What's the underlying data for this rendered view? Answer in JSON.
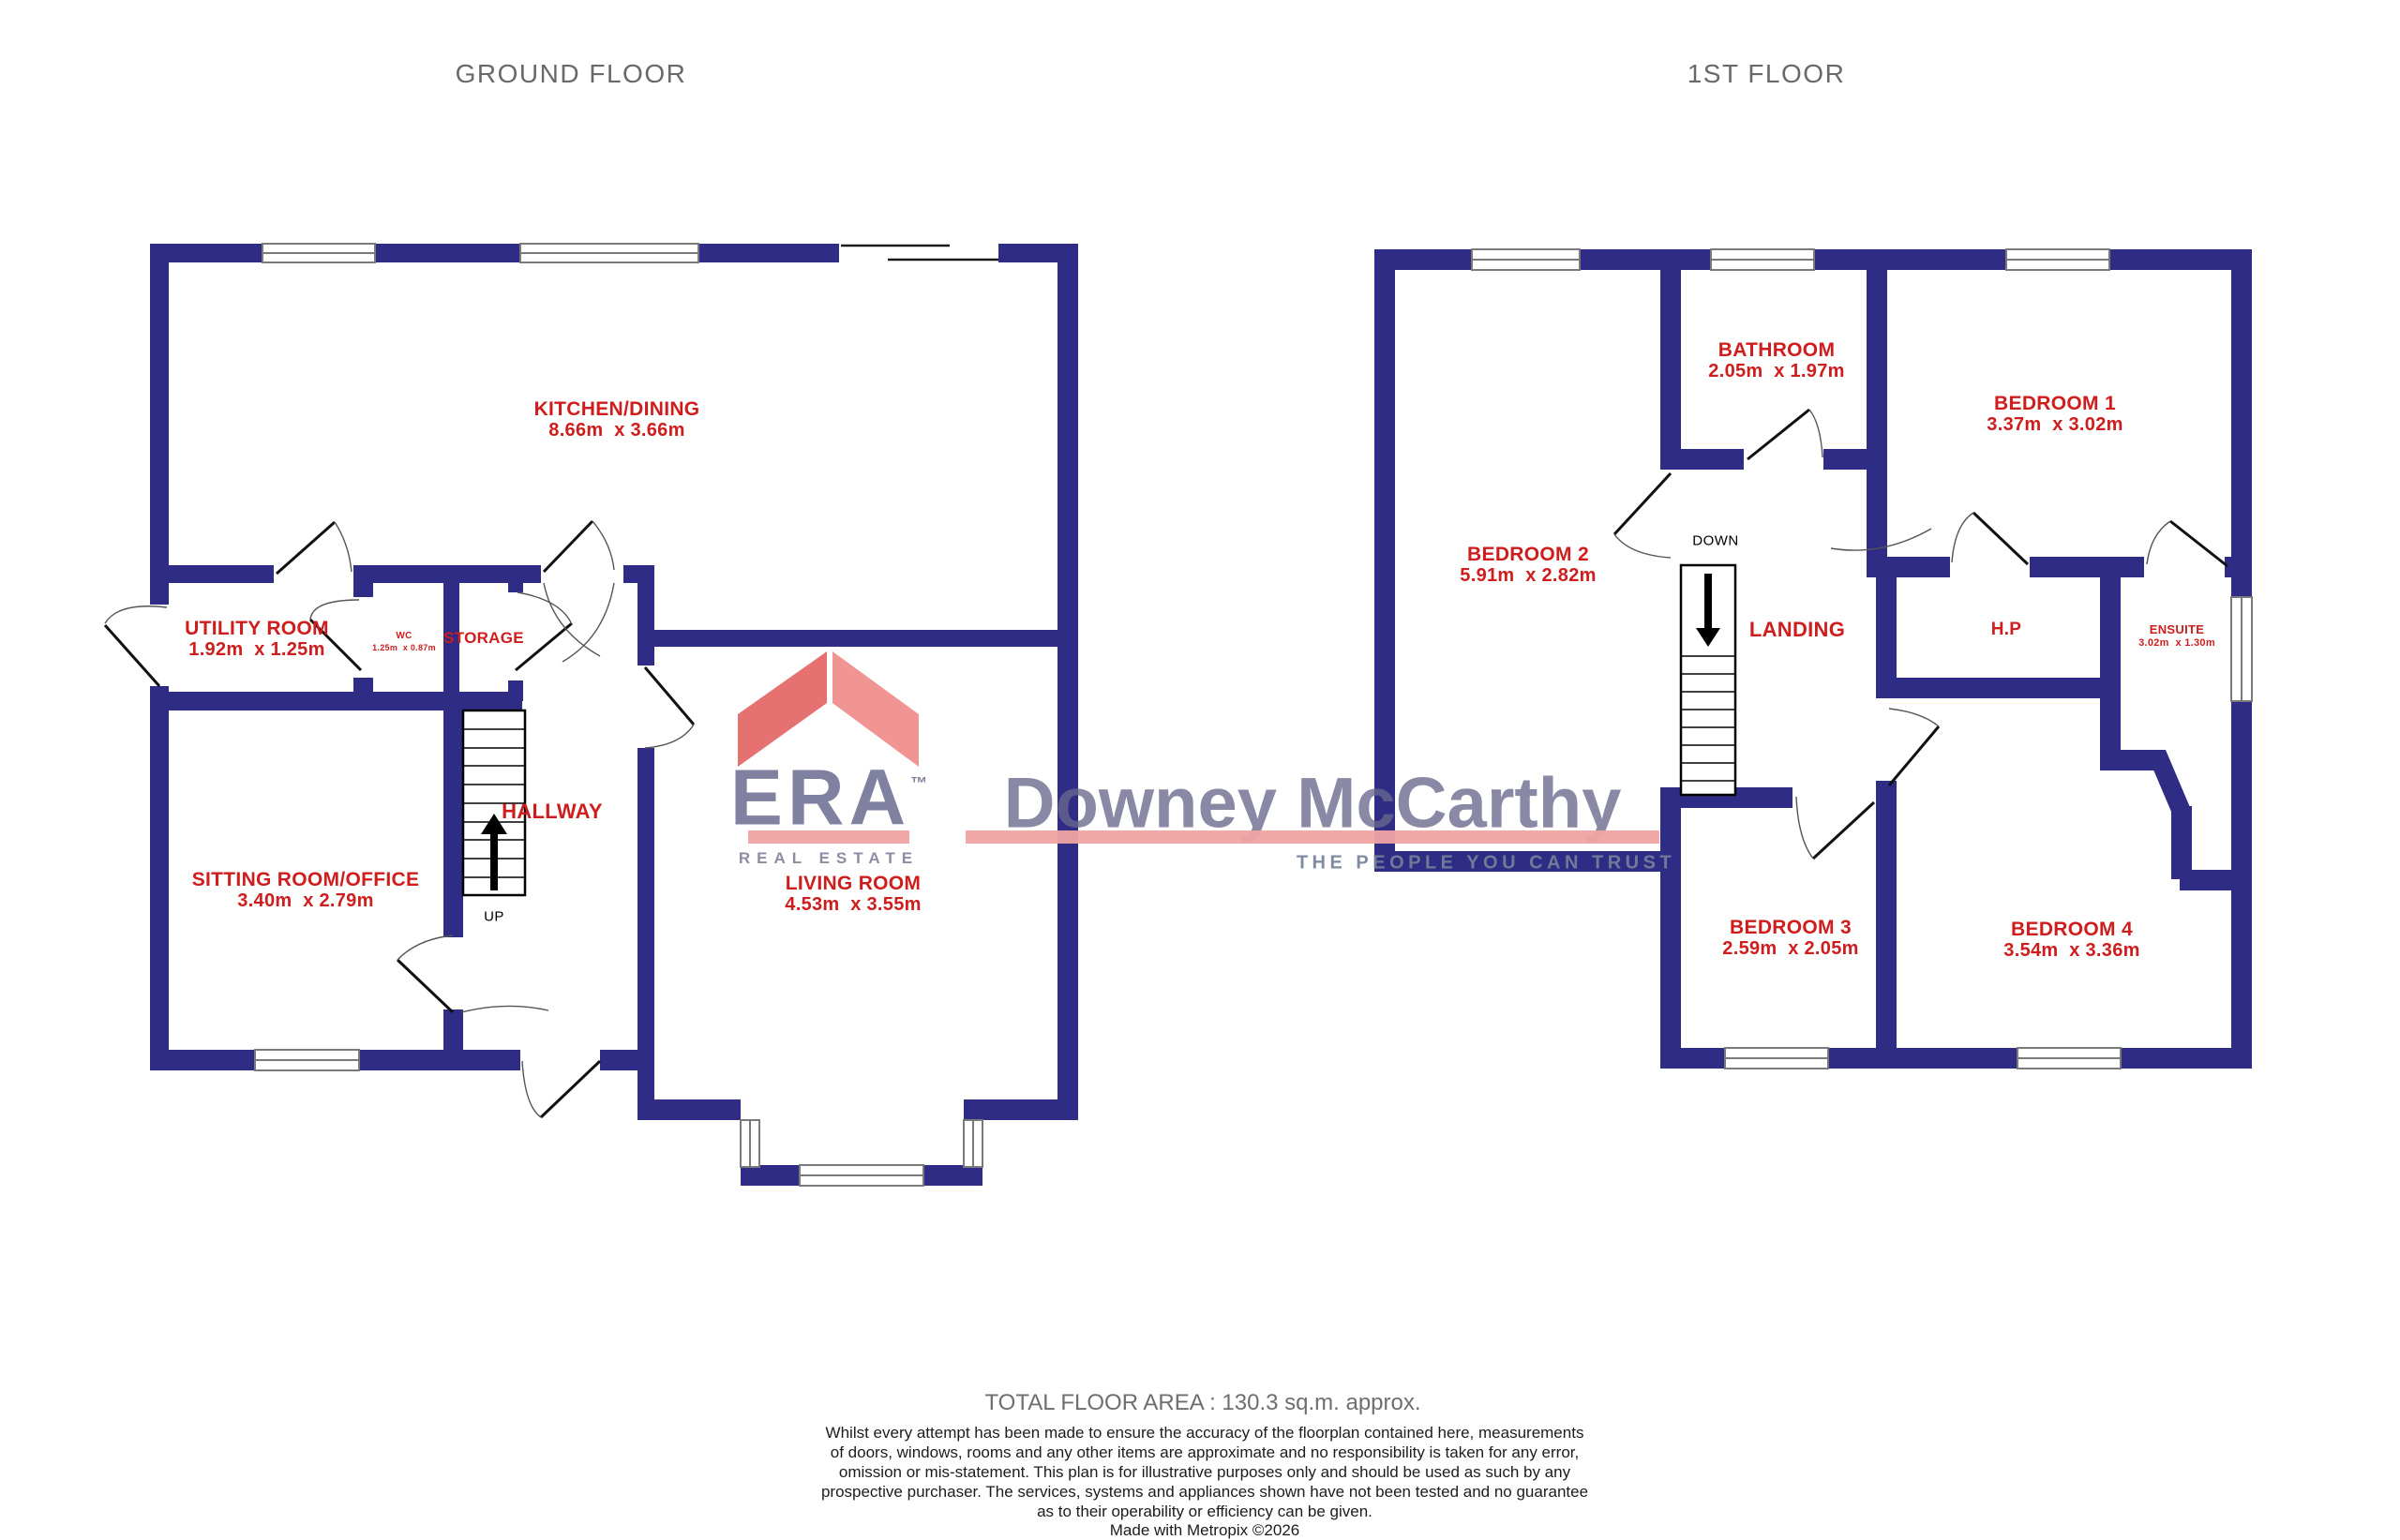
{
  "colors": {
    "wall": "#2f2c86",
    "room_label": "#cf1d1d",
    "floor_title": "#696969",
    "watermark_text": "#6a6a8f",
    "watermark_pink": "#f0a4a3",
    "era_roof_left": "#e57170",
    "era_roof_right": "#f09494"
  },
  "titles": {
    "ground_floor": "GROUND FLOOR",
    "first_floor": "1ST FLOOR"
  },
  "ground_floor": {
    "stairs_label": "UP",
    "rooms": [
      {
        "id": "kitchen_dining",
        "name": "KITCHEN/DINING",
        "dims": "8.66m  x 3.66m"
      },
      {
        "id": "utility_room",
        "name": "UTILITY ROOM",
        "dims": "1.92m  x 1.25m"
      },
      {
        "id": "wc",
        "name": "WC",
        "dims": "1.25m  x 0.87m"
      },
      {
        "id": "storage",
        "name": "STORAGE",
        "dims": ""
      },
      {
        "id": "hallway",
        "name": "HALLWAY",
        "dims": ""
      },
      {
        "id": "sitting_room_office",
        "name": "SITTING ROOM/OFFICE",
        "dims": "3.40m  x 2.79m"
      },
      {
        "id": "living_room",
        "name": "LIVING ROOM",
        "dims": "4.53m  x 3.55m"
      }
    ]
  },
  "first_floor": {
    "stairs_label": "DOWN",
    "rooms": [
      {
        "id": "bathroom",
        "name": "BATHROOM",
        "dims": "2.05m  x 1.97m"
      },
      {
        "id": "bedroom_1",
        "name": "BEDROOM 1",
        "dims": "3.37m  x 3.02m"
      },
      {
        "id": "bedroom_2",
        "name": "BEDROOM 2",
        "dims": "5.91m  x 2.82m"
      },
      {
        "id": "landing",
        "name": "LANDING",
        "dims": ""
      },
      {
        "id": "hot_press",
        "name": "H.P",
        "dims": ""
      },
      {
        "id": "ensuite",
        "name": "ENSUITE",
        "dims": "3.02m  x 1.30m"
      },
      {
        "id": "bedroom_3",
        "name": "BEDROOM 3",
        "dims": "2.59m  x 2.05m"
      },
      {
        "id": "bedroom_4",
        "name": "BEDROOM 4",
        "dims": "3.54m  x 3.36m"
      }
    ]
  },
  "watermark": {
    "brand": "ERA",
    "brand_tm": "™",
    "brand_sub": "REAL ESTATE",
    "agency": "Downey McCarthy",
    "tagline": "THE PEOPLE YOU CAN TRUST"
  },
  "footer": {
    "total_area": "TOTAL FLOOR AREA : 130.3 sq.m. approx.",
    "disclaimer_lines": [
      "Whilst every attempt has been made to ensure the accuracy of the floorplan contained here, measurements",
      "of doors, windows, rooms and any other items are approximate and no responsibility is taken for any error,",
      "omission or mis-statement. This plan is for illustrative purposes only and should be used as such by any",
      "prospective purchaser. The services, systems and appliances shown have not been tested and no guarantee",
      "as to their operability or efficiency can be given.",
      "Made with Metropix ©2026"
    ]
  }
}
